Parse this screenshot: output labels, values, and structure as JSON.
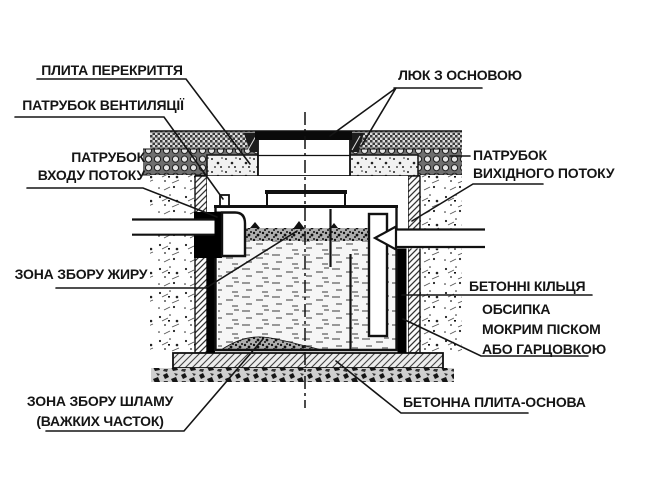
{
  "diagram": {
    "type": "technical-cross-section",
    "subject": "grease-separator-septic-tank-installation",
    "colors": {
      "ink": "#151515",
      "background": "#ffffff"
    },
    "labels": {
      "plyta": "ПЛИТА ПЕРЕКРИТТЯ",
      "ventylyatsiya": "ПАТРУБОК ВЕНТИЛЯЦІЇ",
      "inlet_line1": "ПАТРУБОК",
      "inlet_line2": "ВХОДУ ПОТОКУ",
      "lyuk": "ЛЮК З ОСНОВОЮ",
      "outlet_line1": "ПАТРУБОК",
      "outlet_line2": "ВИХІДНОГО ПОТОКУ",
      "zhyr": "ЗОНА ЗБОРУ ЖИРУ",
      "kiltsya": "БЕТОННІ КІЛЬЦЯ",
      "obsypka_line1": "ОБСИПКА",
      "obsypka_line2": "МОКРИМ ПІСКОМ",
      "obsypka_line3": "АБО ГАРЦОВКОЮ",
      "shlam_line1": "ЗОНА ЗБОРУ ШЛАМУ",
      "shlam_line2": "(ВАЖКИХ ЧАСТОК)",
      "osnova": "БЕТОННА ПЛИТА-ОСНОВА"
    }
  }
}
